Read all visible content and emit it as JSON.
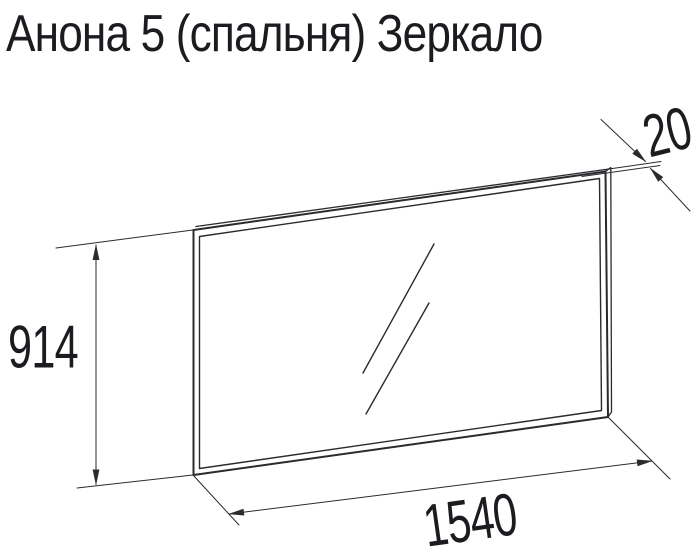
{
  "title": "Анона 5 (спальня) Зеркало",
  "colors": {
    "background": "#ffffff",
    "line": "#2b2b2f",
    "text": "#1c1c20"
  },
  "diagram": {
    "dimensions": {
      "height": "914",
      "width": "1540",
      "depth": "20"
    }
  }
}
